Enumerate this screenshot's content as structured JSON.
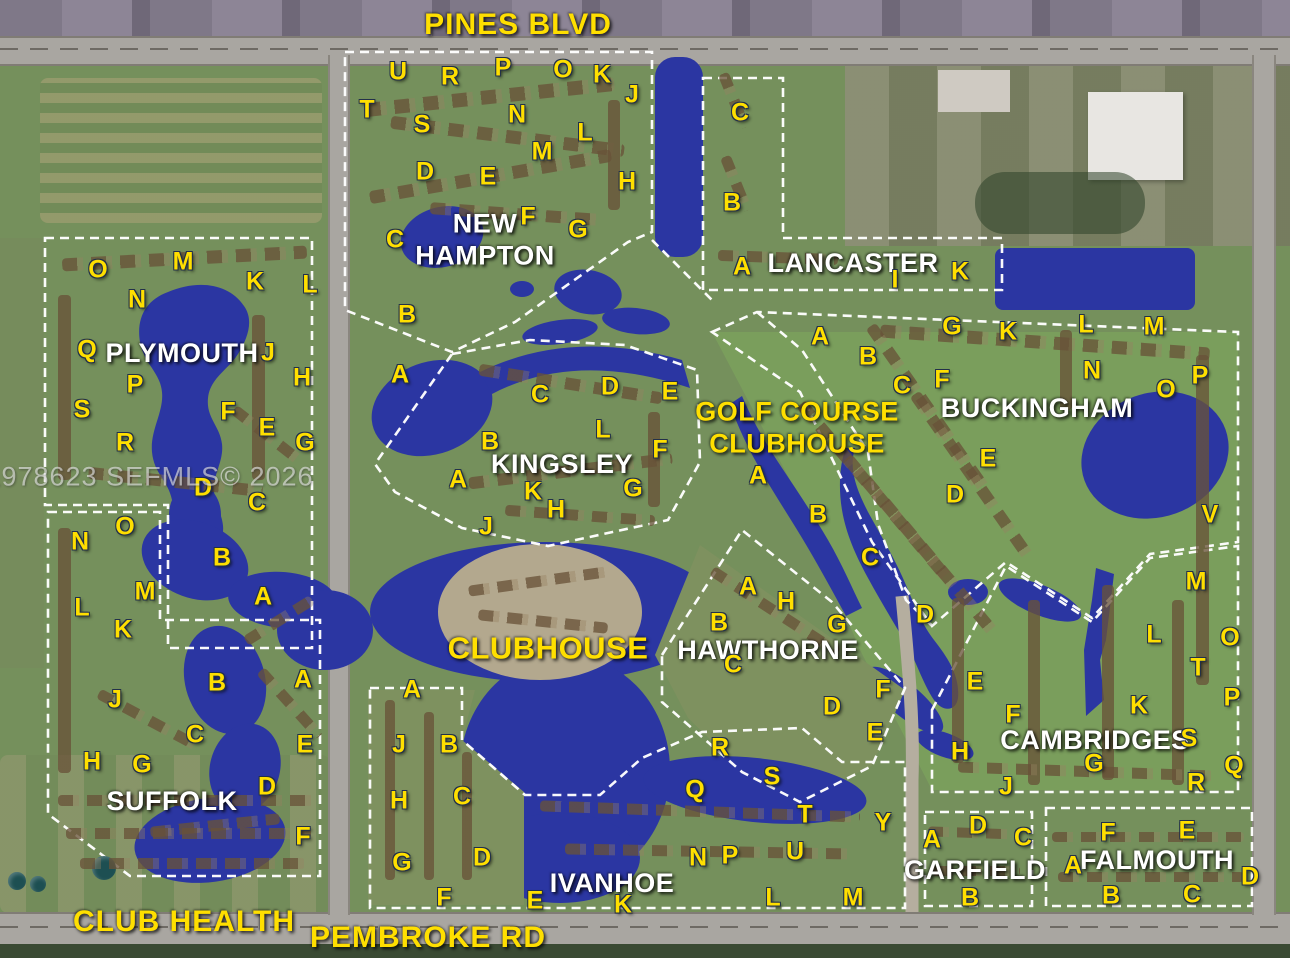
{
  "map": {
    "watermark": "A11978623 SEFMLS© 2026",
    "palette": {
      "letter_yellow": "#FFDF00",
      "label_white": "#FFFFFF",
      "water_blue": "#2B36A2",
      "land_green": "#75905C",
      "golf_green": "#7BA15C",
      "road_gray": "#A9A6A1",
      "boundary_white": "#FFFFFF"
    },
    "places": [
      {
        "id": "pines-blvd",
        "text": "PINES BLVD",
        "x": 518,
        "y": 25,
        "style": "p-road"
      },
      {
        "id": "new-hampton",
        "text": "NEW\nHAMPTON",
        "x": 485,
        "y": 240,
        "style": "p-white"
      },
      {
        "id": "lancaster",
        "text": "LANCASTER",
        "x": 853,
        "y": 263,
        "style": "p-white"
      },
      {
        "id": "plymouth",
        "text": "PLYMOUTH",
        "x": 182,
        "y": 353,
        "style": "p-white"
      },
      {
        "id": "kingsley",
        "text": "KINGSLEY",
        "x": 562,
        "y": 464,
        "style": "p-white"
      },
      {
        "id": "golf-course-clubhouse",
        "text": "GOLF COURSE\nCLUBHOUSE",
        "x": 797,
        "y": 428,
        "style": "p-yellow"
      },
      {
        "id": "buckingham",
        "text": "BUCKINGHAM",
        "x": 1037,
        "y": 408,
        "style": "p-white"
      },
      {
        "id": "clubhouse",
        "text": "CLUBHOUSE",
        "x": 548,
        "y": 648,
        "style": "p-yellow",
        "fs": 31
      },
      {
        "id": "hawthorne",
        "text": "HAWTHORNE",
        "x": 768,
        "y": 650,
        "style": "p-white"
      },
      {
        "id": "cambridges",
        "text": "CAMBRIDGES",
        "x": 1095,
        "y": 740,
        "style": "p-white"
      },
      {
        "id": "suffolk",
        "text": "SUFFOLK",
        "x": 172,
        "y": 801,
        "style": "p-white"
      },
      {
        "id": "ivanhoe",
        "text": "IVANHOE",
        "x": 612,
        "y": 883,
        "style": "p-white"
      },
      {
        "id": "garfield",
        "text": "GARFIELD",
        "x": 975,
        "y": 870,
        "style": "p-white"
      },
      {
        "id": "falmouth",
        "text": "FALMOUTH",
        "x": 1157,
        "y": 860,
        "style": "p-white"
      },
      {
        "id": "club-health",
        "text": "CLUB HEALTH",
        "x": 184,
        "y": 922,
        "style": "p-road"
      },
      {
        "id": "pembroke-rd",
        "text": "PEMBROKE RD",
        "x": 428,
        "y": 938,
        "style": "p-road"
      }
    ],
    "unit_letters": [
      {
        "t": "U",
        "x": 398,
        "y": 72
      },
      {
        "t": "R",
        "x": 450,
        "y": 77
      },
      {
        "t": "P",
        "x": 503,
        "y": 68
      },
      {
        "t": "O",
        "x": 563,
        "y": 70
      },
      {
        "t": "K",
        "x": 602,
        "y": 75
      },
      {
        "t": "J",
        "x": 632,
        "y": 95
      },
      {
        "t": "T",
        "x": 367,
        "y": 110
      },
      {
        "t": "S",
        "x": 422,
        "y": 125
      },
      {
        "t": "N",
        "x": 517,
        "y": 115
      },
      {
        "t": "L",
        "x": 585,
        "y": 133
      },
      {
        "t": "M",
        "x": 542,
        "y": 152
      },
      {
        "t": "D",
        "x": 425,
        "y": 172
      },
      {
        "t": "E",
        "x": 488,
        "y": 177
      },
      {
        "t": "H",
        "x": 627,
        "y": 182
      },
      {
        "t": "F",
        "x": 528,
        "y": 217
      },
      {
        "t": "G",
        "x": 578,
        "y": 230
      },
      {
        "t": "C",
        "x": 395,
        "y": 240
      },
      {
        "t": "B",
        "x": 407,
        "y": 315
      },
      {
        "t": "A",
        "x": 400,
        "y": 375
      },
      {
        "t": "C",
        "x": 740,
        "y": 113
      },
      {
        "t": "B",
        "x": 732,
        "y": 203
      },
      {
        "t": "A",
        "x": 742,
        "y": 267
      },
      {
        "t": "I",
        "x": 895,
        "y": 280
      },
      {
        "t": "K",
        "x": 960,
        "y": 272
      },
      {
        "t": "O",
        "x": 98,
        "y": 270
      },
      {
        "t": "M",
        "x": 183,
        "y": 262
      },
      {
        "t": "K",
        "x": 255,
        "y": 282
      },
      {
        "t": "L",
        "x": 310,
        "y": 285
      },
      {
        "t": "N",
        "x": 137,
        "y": 300
      },
      {
        "t": "Q",
        "x": 87,
        "y": 350
      },
      {
        "t": "J",
        "x": 268,
        "y": 353
      },
      {
        "t": "P",
        "x": 135,
        "y": 385
      },
      {
        "t": "H",
        "x": 302,
        "y": 378
      },
      {
        "t": "S",
        "x": 82,
        "y": 410
      },
      {
        "t": "F",
        "x": 228,
        "y": 412
      },
      {
        "t": "E",
        "x": 267,
        "y": 428
      },
      {
        "t": "G",
        "x": 305,
        "y": 443
      },
      {
        "t": "R",
        "x": 125,
        "y": 443
      },
      {
        "t": "D",
        "x": 203,
        "y": 488
      },
      {
        "t": "C",
        "x": 257,
        "y": 503
      },
      {
        "t": "O",
        "x": 125,
        "y": 527
      },
      {
        "t": "N",
        "x": 80,
        "y": 542
      },
      {
        "t": "B",
        "x": 222,
        "y": 558
      },
      {
        "t": "M",
        "x": 145,
        "y": 592
      },
      {
        "t": "A",
        "x": 263,
        "y": 597
      },
      {
        "t": "L",
        "x": 82,
        "y": 608
      },
      {
        "t": "K",
        "x": 123,
        "y": 630
      },
      {
        "t": "B",
        "x": 217,
        "y": 683
      },
      {
        "t": "A",
        "x": 303,
        "y": 680
      },
      {
        "t": "J",
        "x": 115,
        "y": 700
      },
      {
        "t": "C",
        "x": 195,
        "y": 735
      },
      {
        "t": "E",
        "x": 305,
        "y": 745
      },
      {
        "t": "H",
        "x": 92,
        "y": 762
      },
      {
        "t": "G",
        "x": 142,
        "y": 765
      },
      {
        "t": "D",
        "x": 267,
        "y": 787
      },
      {
        "t": "F",
        "x": 303,
        "y": 837
      },
      {
        "t": "C",
        "x": 540,
        "y": 395
      },
      {
        "t": "D",
        "x": 610,
        "y": 387
      },
      {
        "t": "E",
        "x": 670,
        "y": 392
      },
      {
        "t": "L",
        "x": 603,
        "y": 430
      },
      {
        "t": "B",
        "x": 490,
        "y": 442
      },
      {
        "t": "F",
        "x": 660,
        "y": 450
      },
      {
        "t": "A",
        "x": 458,
        "y": 480
      },
      {
        "t": "K",
        "x": 533,
        "y": 492
      },
      {
        "t": "G",
        "x": 633,
        "y": 489
      },
      {
        "t": "H",
        "x": 556,
        "y": 510
      },
      {
        "t": "J",
        "x": 486,
        "y": 527
      },
      {
        "t": "A",
        "x": 820,
        "y": 337
      },
      {
        "t": "B",
        "x": 868,
        "y": 357
      },
      {
        "t": "G",
        "x": 952,
        "y": 327
      },
      {
        "t": "K",
        "x": 1008,
        "y": 332
      },
      {
        "t": "L",
        "x": 1086,
        "y": 325
      },
      {
        "t": "M",
        "x": 1154,
        "y": 327
      },
      {
        "t": "C",
        "x": 902,
        "y": 386
      },
      {
        "t": "F",
        "x": 942,
        "y": 380
      },
      {
        "t": "N",
        "x": 1092,
        "y": 371
      },
      {
        "t": "O",
        "x": 1166,
        "y": 390
      },
      {
        "t": "P",
        "x": 1200,
        "y": 376
      },
      {
        "t": "E",
        "x": 988,
        "y": 459
      },
      {
        "t": "D",
        "x": 955,
        "y": 495
      },
      {
        "t": "V",
        "x": 1210,
        "y": 515
      },
      {
        "t": "A",
        "x": 758,
        "y": 476
      },
      {
        "t": "B",
        "x": 818,
        "y": 515
      },
      {
        "t": "C",
        "x": 870,
        "y": 558
      },
      {
        "t": "D",
        "x": 925,
        "y": 615
      },
      {
        "t": "A",
        "x": 748,
        "y": 587
      },
      {
        "t": "H",
        "x": 786,
        "y": 602
      },
      {
        "t": "B",
        "x": 719,
        "y": 623
      },
      {
        "t": "G",
        "x": 837,
        "y": 625
      },
      {
        "t": "C",
        "x": 733,
        "y": 665
      },
      {
        "t": "F",
        "x": 883,
        "y": 690
      },
      {
        "t": "D",
        "x": 832,
        "y": 707
      },
      {
        "t": "E",
        "x": 875,
        "y": 733
      },
      {
        "t": "M",
        "x": 1196,
        "y": 582
      },
      {
        "t": "L",
        "x": 1154,
        "y": 635
      },
      {
        "t": "O",
        "x": 1230,
        "y": 638
      },
      {
        "t": "T",
        "x": 1198,
        "y": 668
      },
      {
        "t": "E",
        "x": 975,
        "y": 682
      },
      {
        "t": "P",
        "x": 1232,
        "y": 698
      },
      {
        "t": "K",
        "x": 1139,
        "y": 706
      },
      {
        "t": "F",
        "x": 1013,
        "y": 715
      },
      {
        "t": "S",
        "x": 1189,
        "y": 739
      },
      {
        "t": "H",
        "x": 960,
        "y": 752
      },
      {
        "t": "G",
        "x": 1094,
        "y": 764
      },
      {
        "t": "Q",
        "x": 1234,
        "y": 766
      },
      {
        "t": "J",
        "x": 1006,
        "y": 787
      },
      {
        "t": "R",
        "x": 1196,
        "y": 783
      },
      {
        "t": "A",
        "x": 412,
        "y": 690
      },
      {
        "t": "J",
        "x": 399,
        "y": 745
      },
      {
        "t": "B",
        "x": 449,
        "y": 745
      },
      {
        "t": "H",
        "x": 399,
        "y": 801
      },
      {
        "t": "C",
        "x": 462,
        "y": 797
      },
      {
        "t": "G",
        "x": 402,
        "y": 863
      },
      {
        "t": "D",
        "x": 482,
        "y": 858
      },
      {
        "t": "F",
        "x": 444,
        "y": 898
      },
      {
        "t": "E",
        "x": 535,
        "y": 901
      },
      {
        "t": "K",
        "x": 623,
        "y": 905
      },
      {
        "t": "R",
        "x": 720,
        "y": 748
      },
      {
        "t": "S",
        "x": 772,
        "y": 777
      },
      {
        "t": "Q",
        "x": 695,
        "y": 790
      },
      {
        "t": "T",
        "x": 805,
        "y": 815
      },
      {
        "t": "Y",
        "x": 883,
        "y": 823
      },
      {
        "t": "U",
        "x": 795,
        "y": 852
      },
      {
        "t": "N",
        "x": 698,
        "y": 858
      },
      {
        "t": "P",
        "x": 730,
        "y": 856
      },
      {
        "t": "L",
        "x": 773,
        "y": 898
      },
      {
        "t": "M",
        "x": 853,
        "y": 898
      },
      {
        "t": "A",
        "x": 932,
        "y": 840
      },
      {
        "t": "D",
        "x": 978,
        "y": 826
      },
      {
        "t": "C",
        "x": 1023,
        "y": 838
      },
      {
        "t": "B",
        "x": 970,
        "y": 898
      },
      {
        "t": "F",
        "x": 1108,
        "y": 833
      },
      {
        "t": "E",
        "x": 1187,
        "y": 831
      },
      {
        "t": "A",
        "x": 1073,
        "y": 866
      },
      {
        "t": "D",
        "x": 1250,
        "y": 877
      },
      {
        "t": "B",
        "x": 1111,
        "y": 896
      },
      {
        "t": "C",
        "x": 1192,
        "y": 895
      }
    ]
  }
}
